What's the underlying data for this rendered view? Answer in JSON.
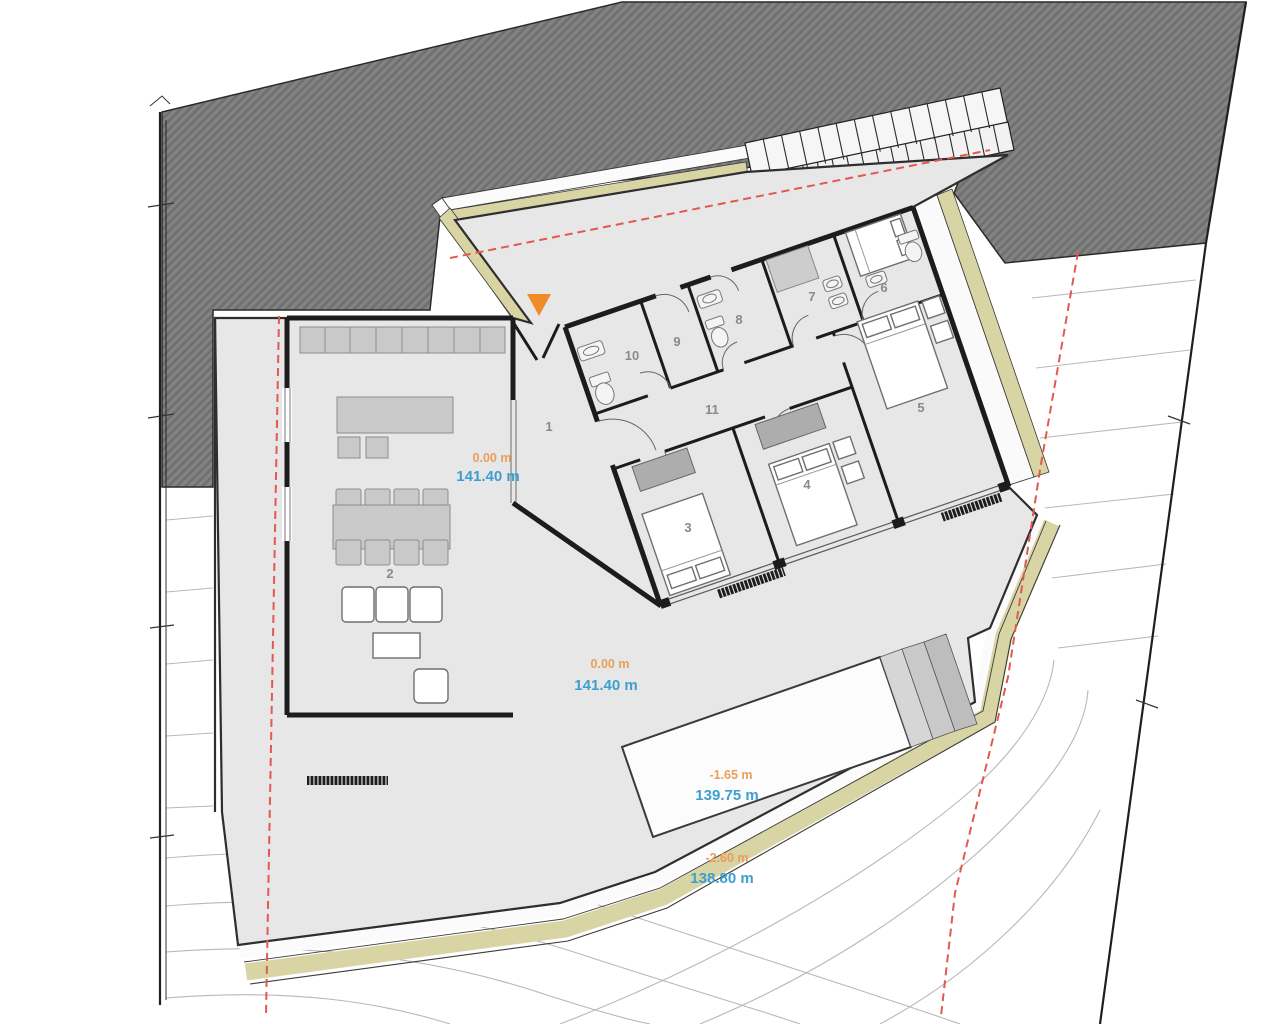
{
  "rooms": [
    {
      "number": "1"
    },
    {
      "number": "2"
    },
    {
      "number": "3"
    },
    {
      "number": "4"
    },
    {
      "number": "5"
    },
    {
      "number": "6"
    },
    {
      "number": "7"
    },
    {
      "number": "8"
    },
    {
      "number": "9"
    },
    {
      "number": "10"
    },
    {
      "number": "11"
    }
  ],
  "elevations": [
    {
      "name": "entry-terrace",
      "level": "0.00 m",
      "altitude": "141.40 m"
    },
    {
      "name": "main-deck",
      "level": "0.00 m",
      "altitude": "141.40 m"
    },
    {
      "name": "pool-terrace",
      "level": "-1.65 m",
      "altitude": "139.75 m"
    },
    {
      "name": "lower-garden",
      "level": "-2.60 m",
      "altitude": "138.80 m"
    }
  ],
  "stair_tread_numbers": [
    "1",
    "2",
    "3",
    "4",
    "5",
    "6",
    "7",
    "8",
    "9",
    "10",
    "11",
    "12",
    "13",
    "14",
    "15",
    "16",
    "17",
    "18",
    "19"
  ],
  "colors": {
    "road_hatch_fill": "#7d7d7d",
    "terrace_fill": "#e7e7e7",
    "garden_band_fill": "#d8d4a4",
    "pool_fill": "#fcfcfc",
    "wall_color": "#1c1c1c",
    "setback_line": "#e05a50",
    "level_label": "#eb9e5b",
    "altitude_label": "#3d9ecf",
    "room_label": "#8a8a8a",
    "entrance_marker": "#ef8b28",
    "contour_line": "#b8b8b8"
  }
}
